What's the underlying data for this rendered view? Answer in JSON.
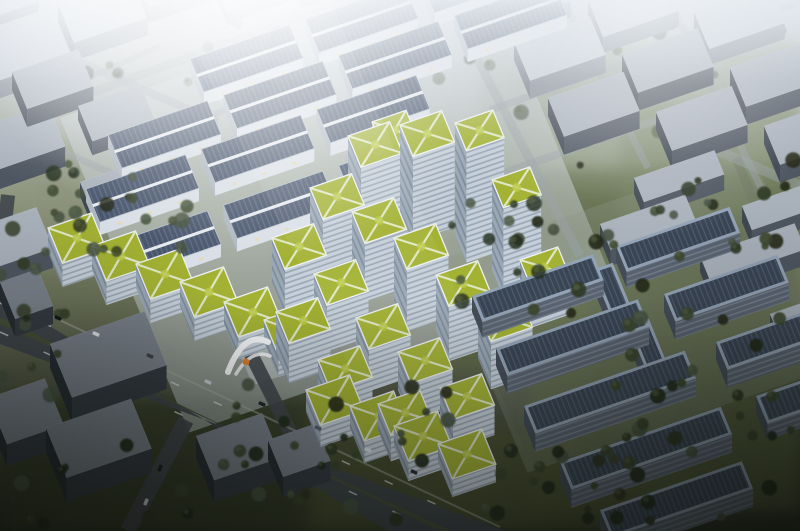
{
  "meta": {
    "title": "Aerial rendering of solar industrial park campus",
    "canvas": {
      "w": 800,
      "h": 531
    }
  },
  "palette": {
    "groundStops": [
      [
        "0%",
        "#c9ced4"
      ],
      [
        "18%",
        "#b2b8b4"
      ],
      [
        "38%",
        "#8d947c"
      ],
      [
        "55%",
        "#6d745a"
      ],
      [
        "75%",
        "#4b5140"
      ],
      [
        "100%",
        "#2a2e22"
      ]
    ],
    "context": {
      "std": {
        "top": "#a9b1bb",
        "left": "#3f4751",
        "front": "#4e5661"
      },
      "h": {
        "top": "#c3c9d1",
        "left": "#767e88",
        "front": "#868e98"
      },
      "d": {
        "top": "#79818b",
        "left": "#262c33",
        "front": "#343a42"
      }
    },
    "warehouse": {
      "wallFront": "#d9dfe6",
      "wallLeft": "#aeb6c0",
      "panel": "#49566c",
      "panelLine": "#5f6e86",
      "ridge": "#eef2f6",
      "eave": "#b7c0cb",
      "warmLight": "#e6d8a6"
    },
    "tower": {
      "front": "#c6d0da",
      "left": "#9aa7b5",
      "windowLine": "rgba(70,88,106,0.55)"
    },
    "greenRoof": {
      "base": "#a3b233",
      "path": "#e6ecd4",
      "parapet": "#edf1f4",
      "patch": "#bac944"
    },
    "solarFlat": {
      "frame": "#93a3b6",
      "panel": "#3a4554",
      "panelLine": "#4e5c6e",
      "front": "#5a6472",
      "left": "#454d59",
      "bandLine": "rgba(185,195,205,0.4)"
    },
    "road": {
      "light": "#9aa1a8",
      "mid": "#6f7566",
      "dark": "#41464d",
      "asphalt": "#3f454c",
      "median": "#474f38",
      "dash": "#d8dce0",
      "edge": "#a9afa6"
    },
    "trees": [
      "#232a1b",
      "#2e3723",
      "#3a452c",
      "#465240"
    ],
    "treeHighlight": "#5b684a",
    "gate": {
      "white": "#f4f6f8",
      "orange": "#d97f2f"
    },
    "glareWhite": "#ffffff",
    "vignette": "#0a0c08"
  },
  "scene": {
    "axes": {
      "U": [
        0.9455,
        -0.3256
      ],
      "V": [
        0.38,
        0.925
      ]
    },
    "grass": [
      [
        530,
        170,
        270,
        340,
        "#57613e",
        0.75
      ],
      [
        300,
        430,
        340,
        101,
        "#474f2e",
        0.8
      ],
      [
        0,
        400,
        310,
        131,
        "#363b26",
        0.8
      ],
      [
        440,
        230,
        150,
        140,
        "#5d6740",
        0.6
      ],
      [
        480,
        40,
        320,
        150,
        "#848e74",
        0.35
      ],
      [
        30,
        140,
        240,
        130,
        "#8b927c",
        0.3
      ],
      [
        620,
        100,
        180,
        120,
        "#76805e",
        0.4
      ]
    ],
    "pavements": [
      [
        60,
        118,
        450,
        340,
        "#c8cfd6",
        0.5
      ],
      [
        440,
        260,
        330,
        230,
        "#8a9183",
        0.32
      ],
      [
        230,
        330,
        70,
        60,
        "#cdd3d8",
        0.5
      ]
    ],
    "streets": [
      [
        20,
        36,
        218,
        122,
        8,
        "l"
      ],
      [
        -10,
        120,
        150,
        190,
        7,
        "l"
      ],
      [
        52,
        94,
        160,
        46,
        6,
        "l"
      ],
      [
        128,
        152,
        252,
        98,
        6,
        "l"
      ],
      [
        60,
        104,
        470,
        -44,
        9,
        "l"
      ],
      [
        462,
        30,
        580,
        256,
        9,
        "l"
      ],
      [
        455,
        190,
        800,
        70,
        8,
        "l"
      ],
      [
        490,
        110,
        800,
        2,
        7,
        "l"
      ],
      [
        560,
        -6,
        648,
        168,
        7,
        "l"
      ],
      [
        672,
        6,
        762,
        190,
        7,
        "l"
      ],
      [
        736,
        158,
        820,
        360,
        9,
        "m"
      ],
      [
        716,
        150,
        800,
        186,
        10,
        "l"
      ],
      [
        186,
        420,
        128,
        531,
        16,
        "d"
      ],
      [
        250,
        352,
        300,
        452,
        14,
        "d"
      ],
      [
        8,
        195,
        -28,
        531,
        14,
        "d"
      ]
    ],
    "boulevard": {
      "outline": [
        [
          0,
          296
        ],
        [
          0,
          344
        ],
        [
          505,
          531
        ],
        [
          388,
          531
        ]
      ],
      "median": [
        [
          0,
          317
        ],
        [
          0,
          324
        ],
        [
          452,
          531
        ],
        [
          440,
          531
        ]
      ],
      "edge": [
        [
          0,
          292
        ],
        [
          500,
          527
        ]
      ],
      "dashLines": [
        {
          "from": [
            0,
            303
          ],
          "to": [
            470,
            520
          ],
          "n": 11
        },
        {
          "from": [
            0,
            332
          ],
          "to": [
            436,
            531
          ],
          "n": 10
        }
      ]
    },
    "contextBlocks": [
      [
        -20,
        0,
        50,
        30,
        10,
        "h"
      ],
      [
        -18,
        58,
        78,
        44,
        18,
        "h"
      ],
      [
        58,
        22,
        78,
        42,
        18,
        "h"
      ],
      [
        134,
        -14,
        78,
        40,
        16,
        "h"
      ],
      [
        214,
        -8,
        72,
        34,
        12,
        "h"
      ],
      [
        290,
        -22,
        72,
        32,
        12,
        "h"
      ],
      [
        -28,
        150,
        80,
        46,
        20,
        "s"
      ],
      [
        12,
        90,
        70,
        40,
        18,
        "s"
      ],
      [
        78,
        120,
        66,
        38,
        14,
        "s"
      ],
      [
        -30,
        250,
        70,
        44,
        20,
        "s"
      ],
      [
        80,
        196,
        92,
        26,
        14,
        "s"
      ],
      [
        480,
        6,
        80,
        40,
        16,
        "h"
      ],
      [
        588,
        16,
        80,
        40,
        16,
        "h"
      ],
      [
        694,
        28,
        80,
        40,
        16,
        "h"
      ],
      [
        514,
        60,
        80,
        42,
        18,
        "h"
      ],
      [
        622,
        72,
        80,
        42,
        18,
        "s"
      ],
      [
        730,
        86,
        80,
        42,
        18,
        "s"
      ],
      [
        548,
        116,
        80,
        42,
        18,
        "s"
      ],
      [
        656,
        130,
        80,
        42,
        18,
        "s"
      ],
      [
        764,
        144,
        80,
        42,
        18,
        "s"
      ],
      [
        634,
        194,
        85,
        26,
        16,
        "s"
      ],
      [
        742,
        222,
        80,
        26,
        16,
        "s"
      ],
      [
        600,
        240,
        90,
        28,
        16,
        "s"
      ],
      [
        700,
        272,
        100,
        28,
        16,
        "s"
      ],
      [
        770,
        330,
        70,
        26,
        16,
        "s"
      ],
      [
        50,
        368,
        100,
        58,
        24,
        "d"
      ],
      [
        -12,
        420,
        60,
        50,
        22,
        "d"
      ],
      [
        46,
        452,
        90,
        54,
        24,
        "d"
      ],
      [
        196,
        458,
        70,
        48,
        22,
        "d"
      ],
      [
        268,
        460,
        50,
        40,
        20,
        "d"
      ],
      [
        0,
        300,
        40,
        40,
        18,
        "d"
      ]
    ],
    "warehouses": {
      "a": 105,
      "b": 36,
      "d": 13,
      "stepU": 122,
      "rows": [
        [
          190,
          72,
          3
        ],
        [
          108,
          148,
          4
        ],
        [
          86,
          202,
          3
        ],
        [
          108,
          258,
          3
        ]
      ]
    },
    "campusBuildings": [
      [
        372,
        150,
        28,
        36,
        30
      ],
      [
        400,
        210,
        85
      ],
      [
        455,
        235,
        112,
        40,
        30
      ],
      [
        492,
        270,
        90,
        40,
        30
      ],
      [
        348,
        196,
        60
      ],
      [
        310,
        240,
        52
      ],
      [
        272,
        282,
        44
      ],
      [
        352,
        270,
        58
      ],
      [
        394,
        300,
        62
      ],
      [
        314,
        320,
        46
      ],
      [
        276,
        352,
        40
      ],
      [
        436,
        330,
        55
      ],
      [
        478,
        358,
        48
      ],
      [
        356,
        360,
        42
      ],
      [
        318,
        394,
        34
      ],
      [
        398,
        390,
        38
      ],
      [
        440,
        418,
        30
      ],
      [
        378,
        430,
        26
      ],
      [
        520,
        300,
        40,
        40,
        30
      ],
      [
        48,
        252,
        24,
        46,
        38
      ],
      [
        92,
        270,
        24,
        46,
        38
      ],
      [
        136,
        288,
        24,
        46,
        38
      ],
      [
        180,
        306,
        24,
        46,
        38
      ],
      [
        224,
        324,
        22,
        46,
        38
      ],
      [
        264,
        342,
        22,
        46,
        38
      ],
      [
        306,
        412,
        22,
        46,
        38
      ],
      [
        350,
        428,
        22,
        46,
        38
      ],
      [
        394,
        446,
        20,
        46,
        38
      ],
      [
        438,
        462,
        18,
        46,
        38
      ]
    ],
    "solarBuildings": [
      [
        472,
        312,
        128,
        28,
        16
      ],
      [
        616,
        262,
        120,
        28,
        16
      ],
      [
        496,
        366,
        150,
        30,
        18
      ],
      [
        664,
        312,
        120,
        30,
        18
      ],
      [
        524,
        424,
        170,
        30,
        18
      ],
      [
        716,
        360,
        90,
        30,
        18
      ],
      [
        560,
        480,
        170,
        30,
        18
      ],
      [
        756,
        412,
        60,
        30,
        16
      ],
      [
        600,
        528,
        150,
        30,
        18
      ],
      [
        592,
        286,
        22,
        62,
        16
      ],
      [
        628,
        344,
        22,
        62,
        18
      ]
    ],
    "treeZones": [
      {
        "r": [
          0,
          52,
          240,
          120
        ],
        "n": 16,
        "op": 0.55,
        "layer": "back"
      },
      {
        "r": [
          180,
          20,
          280,
          70
        ],
        "n": 12,
        "op": 0.4,
        "layer": "back"
      },
      {
        "r": [
          460,
          10,
          340,
          150
        ],
        "n": 20,
        "op": 0.5,
        "layer": "back"
      },
      {
        "r": [
          0,
          150,
          150,
          130
        ],
        "n": 16,
        "op": 0.8,
        "layer": "front"
      },
      {
        "r": [
          40,
          190,
          190,
          70
        ],
        "n": 10,
        "op": 0.85,
        "layer": "front"
      },
      {
        "r": [
          530,
          160,
          270,
          190
        ],
        "n": 32,
        "op": 0.9,
        "layer": "front"
      },
      {
        "r": [
          590,
          350,
          210,
          180
        ],
        "n": 26,
        "op": 0.95,
        "layer": "front"
      },
      {
        "r": [
          0,
          420,
          430,
          110
        ],
        "n": 26,
        "op": 0.95,
        "layer": "front"
      },
      {
        "r": [
          230,
          370,
          220,
          90
        ],
        "n": 12,
        "op": 0.9,
        "layer": "front"
      },
      {
        "r": [
          440,
          200,
          120,
          110
        ],
        "n": 12,
        "op": 0.8,
        "layer": "front"
      },
      {
        "r": [
          460,
          440,
          160,
          91
        ],
        "n": 14,
        "op": 0.95,
        "layer": "front"
      },
      {
        "r": [
          0,
          270,
          70,
          140
        ],
        "n": 10,
        "op": 0.8,
        "layer": "front"
      }
    ],
    "cars": [
      [
        58,
        318,
        23,
        "#15181b"
      ],
      [
        96,
        334,
        23,
        "#e2e5e8"
      ],
      [
        150,
        356,
        23,
        "#3c434a"
      ],
      [
        208,
        382,
        23,
        "#c7ccd1"
      ],
      [
        262,
        404,
        23,
        "#20242a"
      ],
      [
        318,
        428,
        23,
        "#576069"
      ],
      [
        368,
        450,
        23,
        "#dfe2e6"
      ],
      [
        414,
        472,
        23,
        "#2a2f35"
      ],
      [
        160,
        468,
        113,
        "#1a1e22"
      ],
      [
        146,
        502,
        113,
        "#d5d9dc"
      ]
    ],
    "gate": {
      "x": 246,
      "y": 358
    },
    "fx": {
      "glare": [
        [
          258,
          -40,
          300,
          0.95
        ],
        [
          640,
          10,
          230,
          0.42
        ],
        [
          80,
          -20,
          210,
          0.5
        ]
      ],
      "hazeTop": [
        [
          "0%",
          "0.9"
        ],
        [
          "28%",
          "0.25"
        ],
        [
          "55%",
          "0"
        ]
      ],
      "beam": {
        "pts": [
          [
            170,
            0
          ],
          [
            330,
            0
          ],
          [
            560,
            531
          ],
          [
            430,
            531
          ]
        ],
        "op": 0.1
      },
      "vignetteBottom": [
        [
          "56%",
          "0"
        ],
        [
          "100%",
          "0.5"
        ]
      ],
      "corners": [
        [
          0,
          531,
          330,
          0.38
        ],
        [
          800,
          531,
          330,
          0.42
        ]
      ]
    }
  }
}
